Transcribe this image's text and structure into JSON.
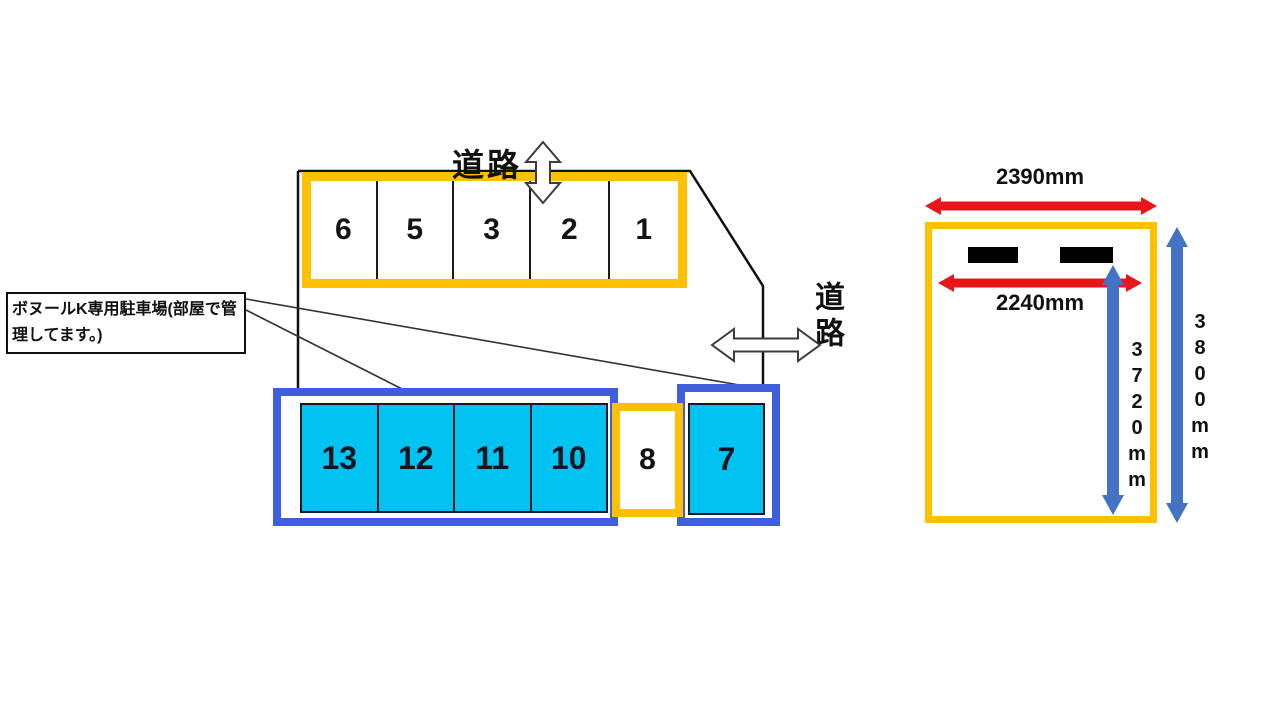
{
  "note": {
    "text": "ボヌールK専用駐車場(部屋で管理してます。)"
  },
  "roads": {
    "top_label": "道路",
    "right_label": "道路"
  },
  "parking": {
    "top_row": [
      "6",
      "5",
      "3",
      "2",
      "1"
    ],
    "bottom_left_row": [
      "13",
      "12",
      "11",
      "10"
    ],
    "middle_space": "8",
    "right_space": "7"
  },
  "dimensions": {
    "outer_width": "2390mm",
    "inner_width": "2240mm",
    "inner_height": "3720mm",
    "outer_height": "3800mm"
  },
  "colors": {
    "lot_border_orange": "#FFC000",
    "lot_border_blue": "#3E5EDC",
    "space_fill_cyan": "#00C3F2",
    "dimension_arrow_red": "#E8161B",
    "dimension_arrow_blue": "#4472C4"
  }
}
